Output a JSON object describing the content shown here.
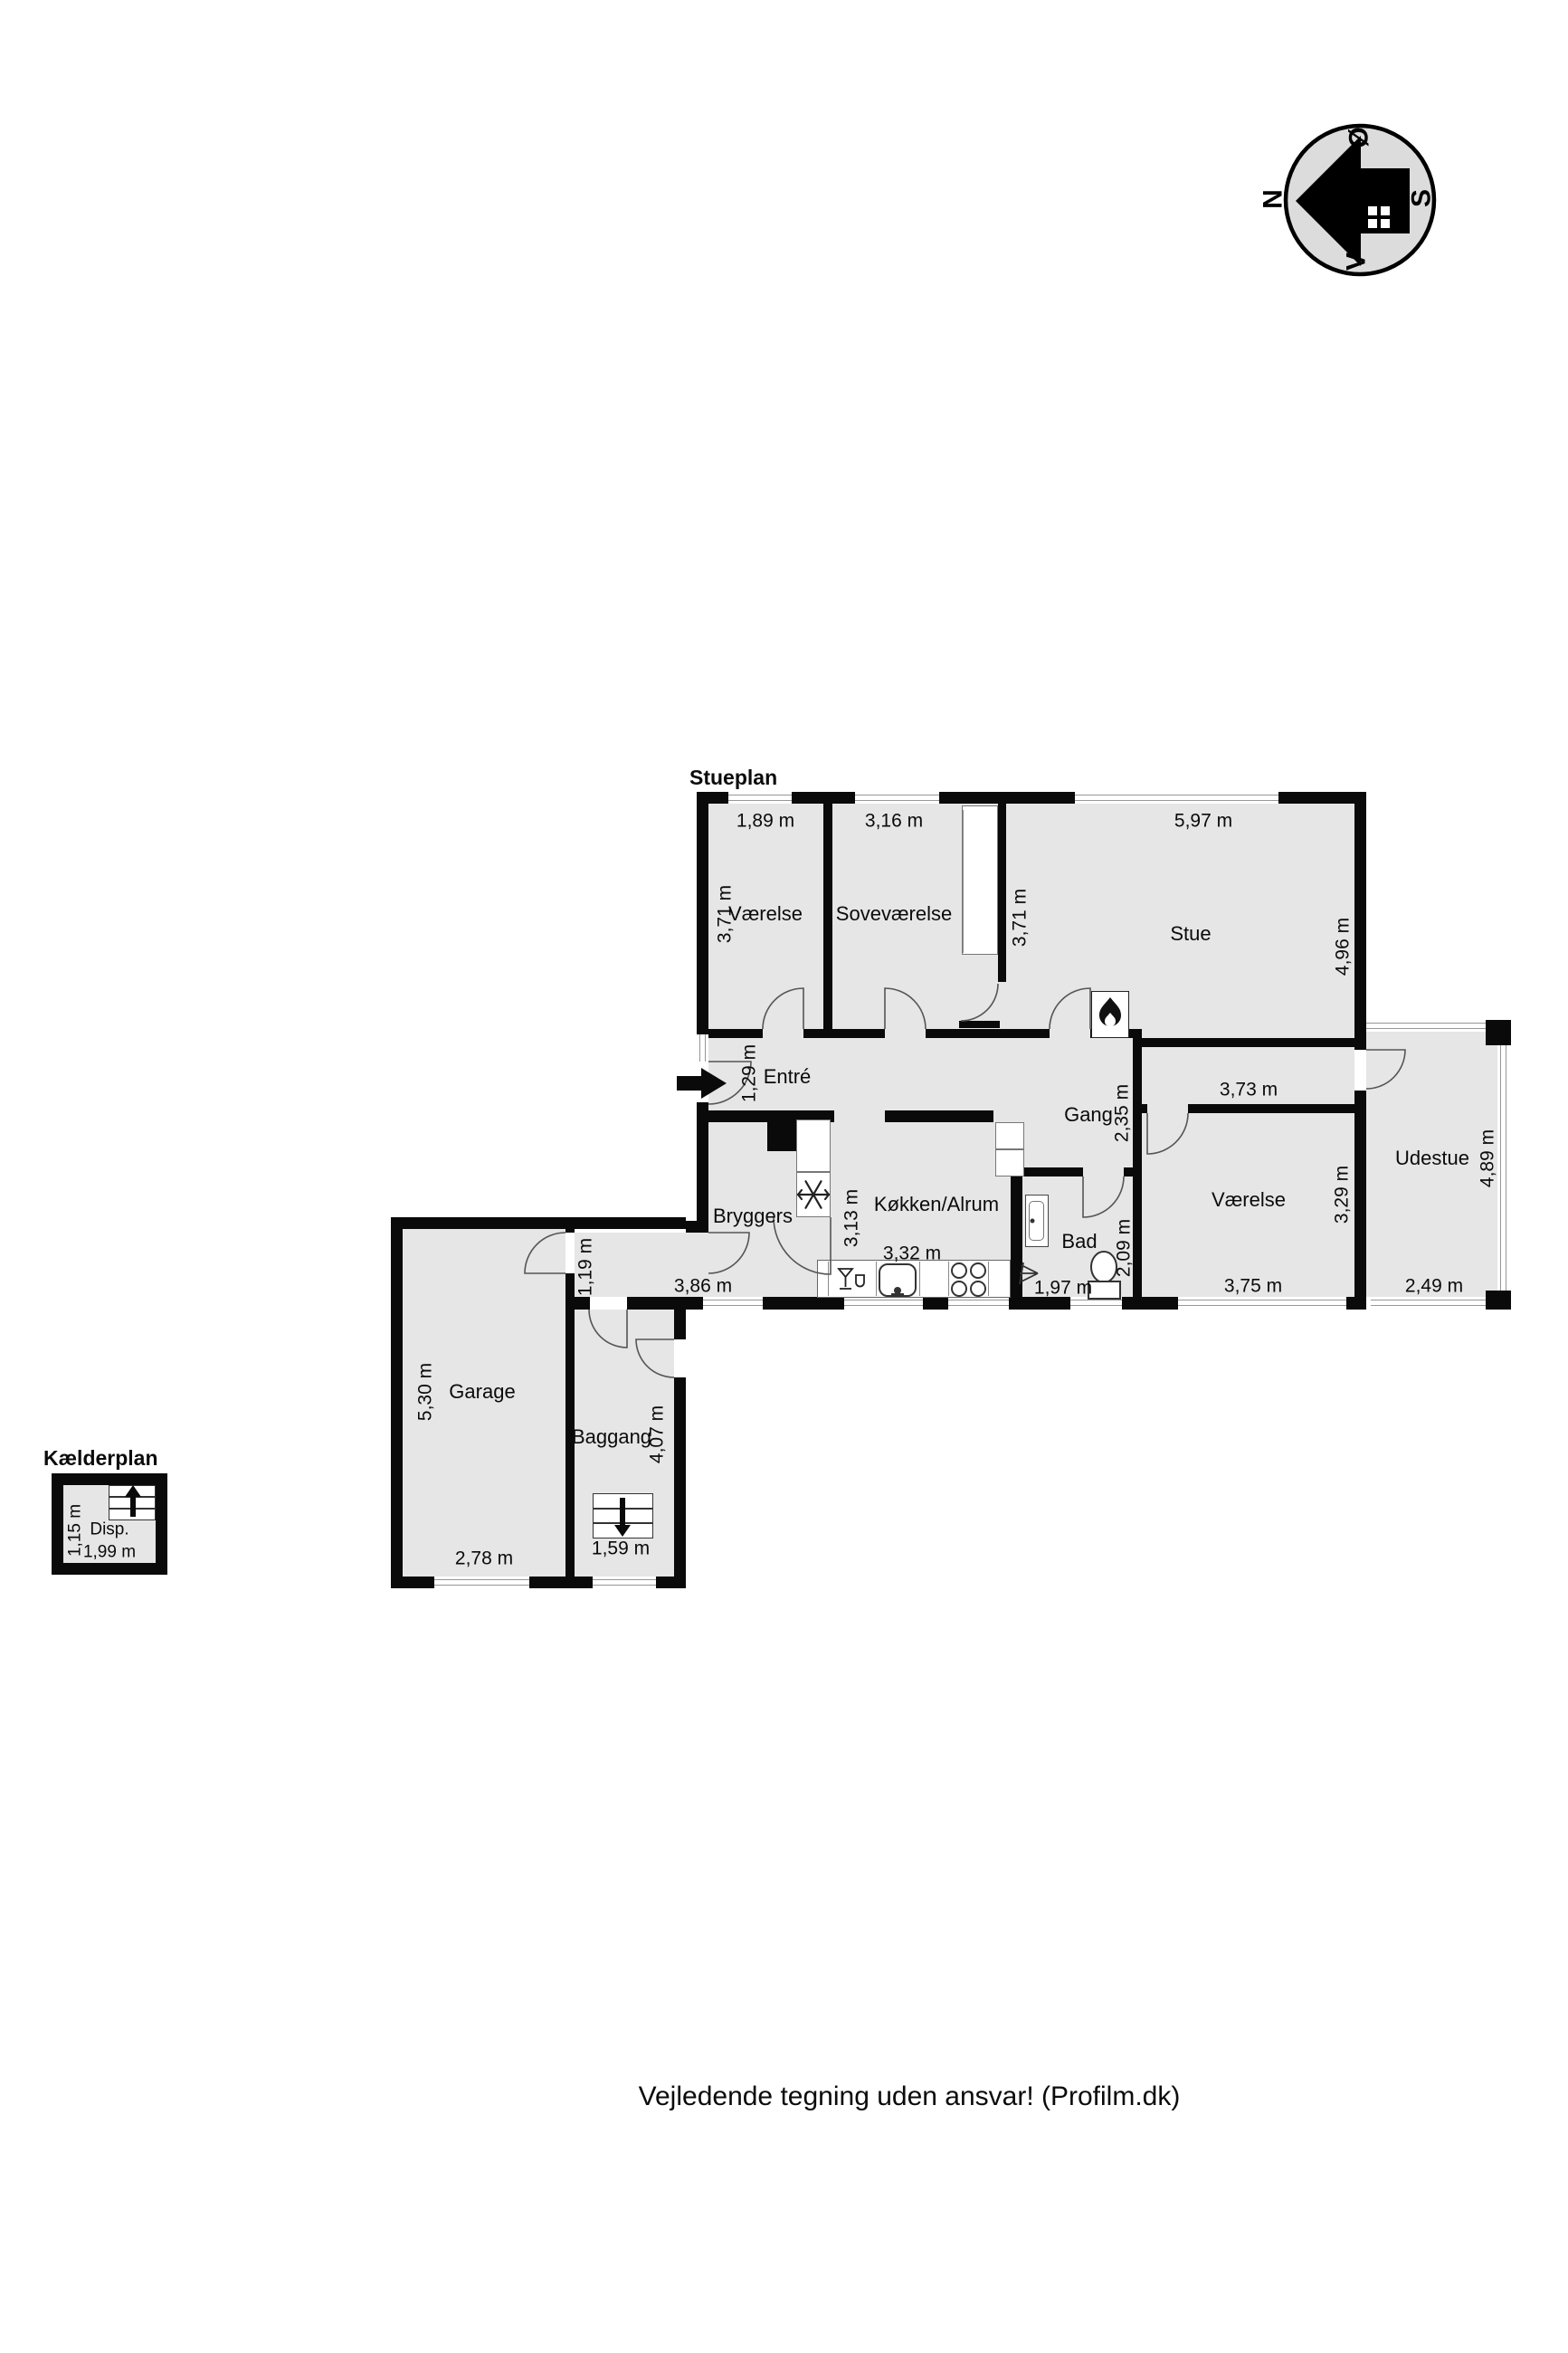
{
  "titles": {
    "stueplan": "Stueplan",
    "kaelderplan": "Kælderplan"
  },
  "disclaimer": "Vejledende tegning uden ansvar! (Profilm.dk)",
  "compass": {
    "n": "N",
    "oe": "Ø",
    "s": "S",
    "v": "V"
  },
  "rooms": {
    "vaerelse_tl": "Værelse",
    "sovevaerelse": "Soveværelse",
    "stue": "Stue",
    "entre": "Entré",
    "gang": "Gang",
    "bryggers": "Bryggers",
    "koekken": "Køkken/Alrum",
    "bad": "Bad",
    "vaerelse_br": "Værelse",
    "udestue": "Udestue",
    "garage": "Garage",
    "baggang": "Baggang",
    "disp": "Disp."
  },
  "dims": {
    "vaerelse_tl_w": "1,89 m",
    "vaerelse_tl_h": "3,71 m",
    "sovevaerelse_w": "3,16 m",
    "sovevaerelse_h": "3,71 m",
    "stue_w": "5,97 m",
    "stue_h": "4,96 m",
    "entre_h": "1,29 m",
    "gang_w": "3,73 m",
    "gang_h": "2,35 m",
    "corridor_w": "3,86 m",
    "corridor_h": "1,19 m",
    "koekken_w": "3,32 m",
    "koekken_h": "3,13 m",
    "bad_w": "1,97 m",
    "bad_h": "2,09 m",
    "vaerelse_br_w": "3,75 m",
    "vaerelse_br_h": "3,29 m",
    "udestue_w": "2,49 m",
    "udestue_h": "4,89 m",
    "garage_w": "2,78 m",
    "garage_h": "5,30 m",
    "baggang_w": "1,59 m",
    "baggang_h": "4,07 m",
    "disp_w": "1,99 m",
    "disp_h": "1,15 m"
  },
  "colors": {
    "wall": "#0a0a0a",
    "room_fill": "#e6e6e6",
    "window_line": "#979797",
    "compass_fill": "#dcdcdc",
    "text": "#000000"
  }
}
